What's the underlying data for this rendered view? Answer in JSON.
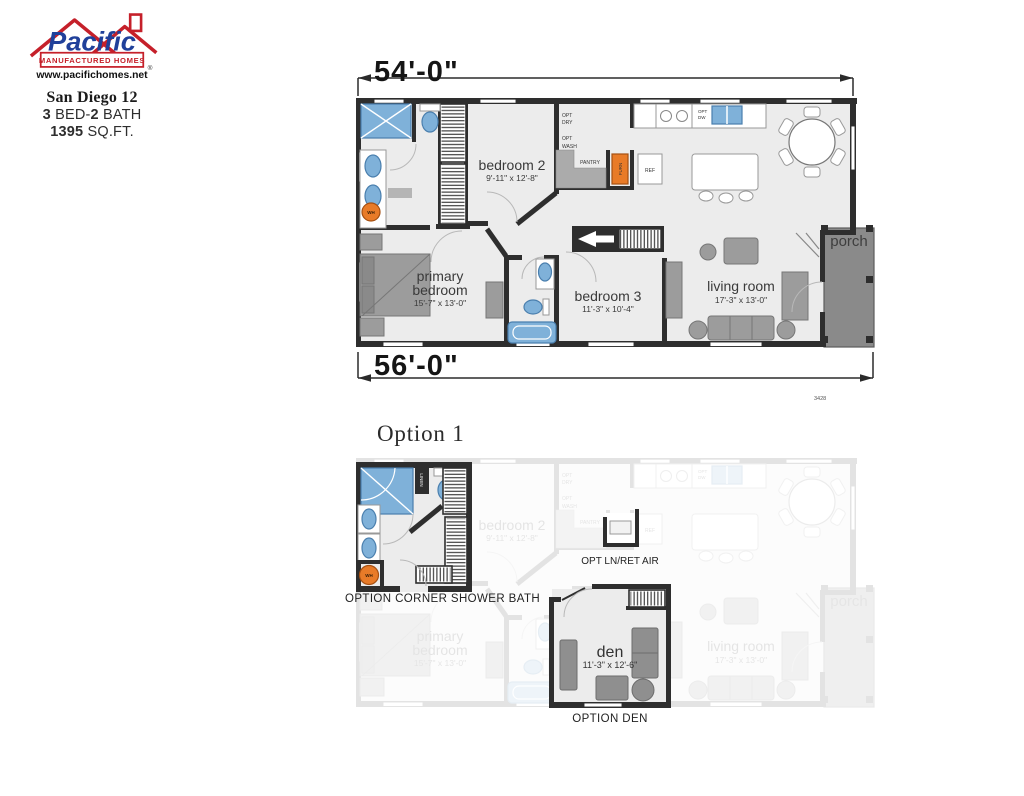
{
  "header": {
    "logo": {
      "brand_script": "Pacific",
      "brand_sub": "MANUFACTURED HOMES",
      "registered": "®",
      "website": "www.pacifichomes.net"
    },
    "model_name": "San Diego 12",
    "specs": {
      "beds": "3",
      "bed_text": " BED-",
      "baths": "2",
      "bath_text": "BATH",
      "sqft": "1395",
      "sqft_text": " SQ.FT."
    }
  },
  "colors": {
    "brand_red": "#c5202a",
    "brand_blue": "#20409a",
    "wall": "#2e2e2e",
    "fixture_blue": "#7fb1d9",
    "appliance_orange": "#e87b28",
    "porch_gray": "#8a8a8a"
  },
  "main_plan": {
    "dim_top": "54'-0\"",
    "dim_bottom": "56'-0\"",
    "plan_number": "3428",
    "rooms": {
      "bedroom2": {
        "name": "bedroom 2",
        "dims": "9'-11\" x 12'-8\""
      },
      "primary": {
        "line1": "primary",
        "line2": "bedroom",
        "dims": "15'-7\" x 13'-0\""
      },
      "bedroom3": {
        "name": "bedroom 3",
        "dims": "11'-3\" x 10'-4\""
      },
      "living": {
        "name": "living room",
        "dims": "17'-3\" x 13'-0\""
      },
      "porch": {
        "name": "porch"
      }
    },
    "labels": {
      "opt": "OPT",
      "dry": "DRY",
      "wash": "WASH",
      "dw": "DW",
      "pantry": "PANTRY",
      "furn": "FURN",
      "ref": "REF",
      "wh": "WH"
    }
  },
  "options": {
    "title": "Option 1",
    "bath_label": "OPTION CORNER SHOWER BATH",
    "linen": "LINEN",
    "wh": "WH",
    "ln_ret_air": "OPT LN/RET AIR",
    "den": {
      "name": "den",
      "dims": "11'-3\" x 12'-6\""
    },
    "den_label": "OPTION DEN"
  }
}
